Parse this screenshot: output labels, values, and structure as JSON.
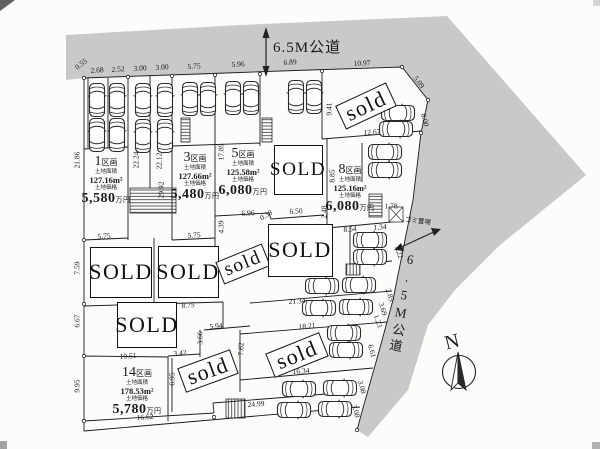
{
  "roads": {
    "top_label": "6.5M公道",
    "right_label": "6.5M公道",
    "garbage_label": "ゴミ置場"
  },
  "compass_label": "N",
  "plot_captions": {
    "plot_suffix": "区画",
    "area_caption": "土地面積",
    "price_caption": "土地価格",
    "price_unit": "万円"
  },
  "plots": [
    {
      "number": "1",
      "area": "127.16m²",
      "price": "5,580",
      "x": 106,
      "y": 152
    },
    {
      "number": "3",
      "area": "127.66m²",
      "price": "5,480",
      "x": 195,
      "y": 148
    },
    {
      "number": "5",
      "area": "125.58m²",
      "price": "6,080",
      "x": 243,
      "y": 144
    },
    {
      "number": "8",
      "area": "125.16m²",
      "price": "6,080",
      "x": 350,
      "y": 160
    },
    {
      "number": "14",
      "area": "178.53m²",
      "price": "5,780",
      "x": 137,
      "y": 363
    }
  ],
  "sold_signs": [
    {
      "label": "sold",
      "x": 366,
      "y": 106,
      "w": 56,
      "h": 26,
      "r": -25
    },
    {
      "label": "SOLD",
      "x": 298,
      "y": 170,
      "w": 49,
      "h": 50,
      "r": 0
    },
    {
      "label": "SOLD",
      "x": 121,
      "y": 272,
      "w": 62,
      "h": 51,
      "r": 0
    },
    {
      "label": "SOLD",
      "x": 188,
      "y": 272,
      "w": 61,
      "h": 52,
      "r": 0
    },
    {
      "label": "sold",
      "x": 243,
      "y": 264,
      "w": 50,
      "h": 24,
      "r": -22
    },
    {
      "label": "SOLD",
      "x": 300,
      "y": 250,
      "w": 65,
      "h": 53,
      "r": 0
    },
    {
      "label": "SOLD",
      "x": 147,
      "y": 325,
      "w": 60,
      "h": 46,
      "r": 0
    },
    {
      "label": "sold",
      "x": 297,
      "y": 355,
      "w": 58,
      "h": 26,
      "r": -22
    },
    {
      "label": "sold",
      "x": 208,
      "y": 371,
      "w": 56,
      "h": 26,
      "r": -20
    }
  ],
  "dimensions": [
    {
      "t": "0.55",
      "x": 81,
      "y": 64,
      "r": -38
    },
    {
      "t": "2.68",
      "x": 97,
      "y": 70,
      "r": -3
    },
    {
      "t": "2.52",
      "x": 118,
      "y": 69,
      "r": -3
    },
    {
      "t": "3.00",
      "x": 140,
      "y": 68,
      "r": -3
    },
    {
      "t": "3.00",
      "x": 162,
      "y": 67,
      "r": -3
    },
    {
      "t": "5.75",
      "x": 194,
      "y": 66,
      "r": -3
    },
    {
      "t": "5.96",
      "x": 238,
      "y": 64,
      "r": -3
    },
    {
      "t": "6.89",
      "x": 290,
      "y": 62,
      "r": -3
    },
    {
      "t": "10.97",
      "x": 362,
      "y": 63,
      "r": -3
    },
    {
      "t": "5.09",
      "x": 419,
      "y": 82,
      "r": 52
    },
    {
      "t": "9.41",
      "x": 329,
      "y": 109,
      "r": -90
    },
    {
      "t": "12.67",
      "x": 372,
      "y": 132,
      "r": -4
    },
    {
      "t": "8.00",
      "x": 425,
      "y": 120,
      "r": 75
    },
    {
      "t": "21.86",
      "x": 77,
      "y": 160,
      "r": -90
    },
    {
      "t": "22.24",
      "x": 136,
      "y": 160,
      "r": -90
    },
    {
      "t": "22.12",
      "x": 159,
      "y": 161,
      "r": -90
    },
    {
      "t": "29.92",
      "x": 161,
      "y": 190,
      "r": -90
    },
    {
      "t": "17.89",
      "x": 221,
      "y": 152,
      "r": -90
    },
    {
      "t": "8.85",
      "x": 332,
      "y": 176,
      "r": -90
    },
    {
      "t": "1.78",
      "x": 391,
      "y": 206,
      "r": 0
    },
    {
      "t": "6.96",
      "x": 248,
      "y": 213,
      "r": -3
    },
    {
      "t": "0.38",
      "x": 266,
      "y": 215,
      "r": -30
    },
    {
      "t": "6.50",
      "x": 296,
      "y": 211,
      "r": -3
    },
    {
      "t": "2.48",
      "x": 324,
      "y": 212,
      "r": -90
    },
    {
      "t": "4.39",
      "x": 221,
      "y": 227,
      "r": -90
    },
    {
      "t": "5.75",
      "x": 104,
      "y": 236,
      "r": -3
    },
    {
      "t": "5.75",
      "x": 194,
      "y": 235,
      "r": -3
    },
    {
      "t": "8.54",
      "x": 350,
      "y": 229,
      "r": -4
    },
    {
      "t": "1.34",
      "x": 380,
      "y": 227,
      "r": -4
    },
    {
      "t": "7.22",
      "x": 399,
      "y": 252,
      "r": 70
    },
    {
      "t": "7.59",
      "x": 77,
      "y": 268,
      "r": -90
    },
    {
      "t": "2.85",
      "x": 390,
      "y": 295,
      "r": 72
    },
    {
      "t": "21.34",
      "x": 297,
      "y": 301,
      "r": -4
    },
    {
      "t": "8.75",
      "x": 188,
      "y": 305,
      "r": -4
    },
    {
      "t": "3.69",
      "x": 383,
      "y": 309,
      "r": 72
    },
    {
      "t": "1.23",
      "x": 378,
      "y": 321,
      "r": 72
    },
    {
      "t": "6.67",
      "x": 77,
      "y": 321,
      "r": -90
    },
    {
      "t": "5.94",
      "x": 216,
      "y": 326,
      "r": -4
    },
    {
      "t": "18.21",
      "x": 307,
      "y": 326,
      "r": -4
    },
    {
      "t": "3.66",
      "x": 200,
      "y": 338,
      "r": -90
    },
    {
      "t": "7.62",
      "x": 241,
      "y": 349,
      "r": -90
    },
    {
      "t": "6.61",
      "x": 372,
      "y": 351,
      "r": 75
    },
    {
      "t": "3.42",
      "x": 180,
      "y": 353,
      "r": -4
    },
    {
      "t": "10.51",
      "x": 128,
      "y": 356,
      "r": -4
    },
    {
      "t": "16.34",
      "x": 301,
      "y": 371,
      "r": -4
    },
    {
      "t": "6.95",
      "x": 172,
      "y": 379,
      "r": -90
    },
    {
      "t": "9.95",
      "x": 77,
      "y": 386,
      "r": -90
    },
    {
      "t": "3.08",
      "x": 362,
      "y": 387,
      "r": 75
    },
    {
      "t": "24.99",
      "x": 256,
      "y": 404,
      "r": -4
    },
    {
      "t": "3.08",
      "x": 356,
      "y": 411,
      "r": 75
    },
    {
      "t": "16.62",
      "x": 145,
      "y": 417,
      "r": -4
    }
  ],
  "cars": [
    {
      "x": 97,
      "y": 100,
      "r": 0
    },
    {
      "x": 117,
      "y": 100,
      "r": 0
    },
    {
      "x": 143,
      "y": 100,
      "r": 0
    },
    {
      "x": 165,
      "y": 100,
      "r": 0
    },
    {
      "x": 190,
      "y": 99,
      "r": 0
    },
    {
      "x": 208,
      "y": 99,
      "r": 0
    },
    {
      "x": 233,
      "y": 98,
      "r": 0
    },
    {
      "x": 251,
      "y": 98,
      "r": 0
    },
    {
      "x": 296,
      "y": 97,
      "r": 0
    },
    {
      "x": 314,
      "y": 97,
      "r": 0
    },
    {
      "x": 97,
      "y": 135,
      "r": 0
    },
    {
      "x": 117,
      "y": 135,
      "r": 0
    },
    {
      "x": 143,
      "y": 136,
      "r": 0
    },
    {
      "x": 165,
      "y": 136,
      "r": 0
    },
    {
      "x": 398,
      "y": 113,
      "r": 90
    },
    {
      "x": 396,
      "y": 129,
      "r": 90
    },
    {
      "x": 385,
      "y": 152,
      "r": 90
    },
    {
      "x": 385,
      "y": 170,
      "r": 90
    },
    {
      "x": 370,
      "y": 240,
      "r": 90
    },
    {
      "x": 370,
      "y": 257,
      "r": 90
    },
    {
      "x": 322,
      "y": 286,
      "r": 90
    },
    {
      "x": 359,
      "y": 285,
      "r": 90
    },
    {
      "x": 319,
      "y": 308,
      "r": 90
    },
    {
      "x": 356,
      "y": 307,
      "r": 90
    },
    {
      "x": 344,
      "y": 333,
      "r": 90
    },
    {
      "x": 346,
      "y": 350,
      "r": 90
    },
    {
      "x": 299,
      "y": 389,
      "r": 90
    },
    {
      "x": 340,
      "y": 388,
      "r": 90
    },
    {
      "x": 294,
      "y": 410,
      "r": 90
    },
    {
      "x": 335,
      "y": 409,
      "r": 90
    }
  ]
}
